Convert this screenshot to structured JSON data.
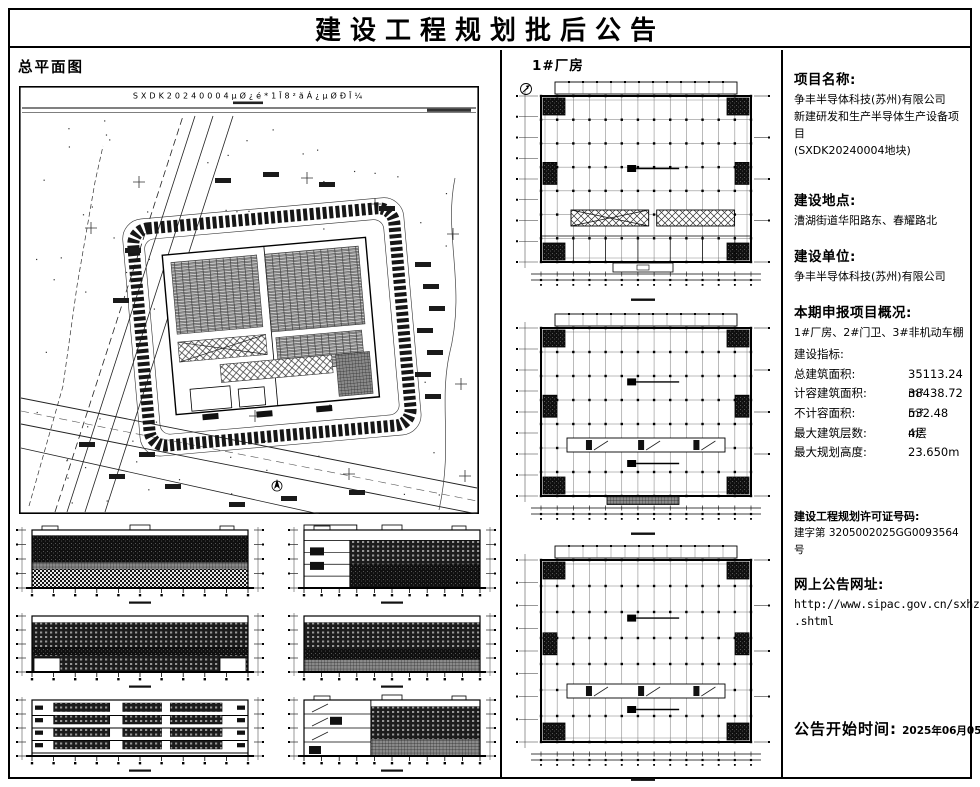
{
  "page": {
    "title": "建设工程规划批后公告"
  },
  "left": {
    "site_plan_label": "总平面图",
    "site_plan_title": "SXDK20240004μØ¿é*1Ī8²ãÁ¿μØÐĪ¼"
  },
  "center": {
    "label": "1#厂房"
  },
  "right": {
    "project_name": {
      "heading": "项目名称:",
      "lines": [
        "争丰半导体科技(苏州)有限公司",
        "新建研发和生产半导体生产设备项目",
        "(SXDK20240004地块)"
      ]
    },
    "location": {
      "heading": "建设地点:",
      "line": "漕湖街道华阳路东、春耀路北"
    },
    "builder": {
      "heading": "建设单位:",
      "line": "争丰半导体科技(苏州)有限公司"
    },
    "overview": {
      "heading": "本期申报项目概况:",
      "line": "1#厂房、2#门卫、3#非机动车棚"
    },
    "indicators": {
      "heading": "建设指标:",
      "rows": [
        {
          "label": "总建筑面积:",
          "value": "35113.24 m²"
        },
        {
          "label": "计容建筑面积:",
          "value": "38438.72 m²"
        },
        {
          "label": "不计容面积:",
          "value": "532.48 m²"
        },
        {
          "label": "最大建筑层数:",
          "value": "4层"
        },
        {
          "label": "最大规划高度:",
          "value": "23.650m"
        }
      ]
    },
    "permit": {
      "heading": "建设工程规划许可证号码:",
      "line": "建字第 3205002025GG0093564 号"
    },
    "website": {
      "heading": "网上公告网址:",
      "lines": [
        "http://www.sipac.gov.cn/sxhzq/index",
        ".shtml"
      ]
    },
    "announcement": {
      "label": "公告开始时间:",
      "value": "2025年06月05日"
    }
  }
}
